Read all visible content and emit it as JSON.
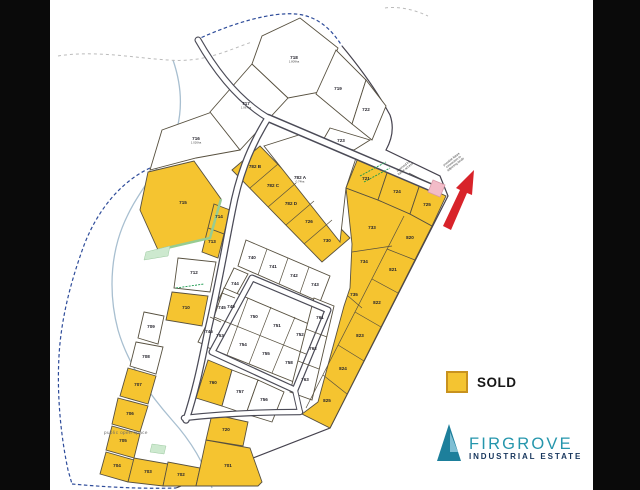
{
  "window": {
    "bar_color": "#0a0a0a",
    "bg": "#ffffff"
  },
  "legend": {
    "label": "SOLD",
    "swatch_color": "#F4C431",
    "swatch_border": "#C8921E"
  },
  "logo": {
    "title": "FIRGROVE",
    "subtitle": "INDUSTRIAL ESTATE",
    "teal": "#1D7F9B",
    "light_blue": "#7FBFD4",
    "navy": "#16355C"
  },
  "map": {
    "colors": {
      "sold": "#F5C430",
      "available": "#ffffff",
      "lot_line": "#57503f",
      "road_casing": "#4b4b57",
      "road_fill": "#ffffff",
      "label": "#26252e",
      "boundary_blue": "#2E4C9A",
      "stream": "#A8BFD0",
      "green": "#18984C",
      "arrow_red": "#D8232A",
      "pink": "#F3BCC8"
    },
    "paths": [
      {
        "d": "M150,168 C120,182 96,212 83,248 C70,284 61,320 59,356 C57,392 60,432 68,470 L72,484",
        "s": "#2E4C9A",
        "w": 1.2,
        "dash": "3.5,2.5"
      },
      {
        "d": "M72,484 C105,487 140,489 176,488",
        "s": "#2E4C9A",
        "w": 1.2,
        "dash": "3.5,2.5"
      },
      {
        "d": "M196,40 C235,22 272,12 296,14 C318,16 332,30 342,46",
        "s": "#2E4C9A",
        "w": 1.2,
        "dash": "3.5,2.5"
      },
      {
        "d": "M342,46 Q372,82 390,115 Q396,132 386,150 L440,176 L448,196 L330,428 L176,488",
        "s": "#45424e",
        "w": 1.2
      },
      {
        "d": "M173,60 C185,95 182,125 168,152 C150,180 128,205 118,240 C110,268 110,300 118,330 C128,365 150,395 172,420 C190,440 204,462 212,488",
        "s": "#A8BFD0",
        "w": 1.3
      },
      {
        "d": "M58,56 C95,50 135,58 168,60 C205,63 228,50 252,42",
        "s": "#bbbbbb",
        "w": 1,
        "dash": "3,3"
      },
      {
        "d": "M385,8 C400,6 415,10 428,16",
        "s": "#bbbbbb",
        "w": 1,
        "dash": "3,3"
      }
    ],
    "roads": [
      {
        "d": "M198,40 C215,70 238,100 268,118",
        "cw": 7,
        "fw": 4.8
      },
      {
        "d": "M268,118 L437,190",
        "cw": 8.5,
        "fw": 5.5
      },
      {
        "d": "M268,118 C248,150 238,180 232,212 C224,252 218,288 208,330 C202,360 196,390 186,420",
        "cw": 7.5,
        "fw": 5
      },
      {
        "d": "M252,278 L328,310 L295,390 L212,352 Z",
        "cw": 7,
        "fw": 4.6
      },
      {
        "d": "M295,390 L300,412",
        "cw": 6,
        "fw": 4
      },
      {
        "d": "M184,418 C220,414 262,412 300,412",
        "cw": 6.5,
        "fw": 4.2
      }
    ],
    "lots": [
      {
        "t": "716",
        "sold": false,
        "pts": "162,130 212,112 240,150 196,158 150,170",
        "x": 196,
        "y": 140,
        "a": "1.026ha"
      },
      {
        "t": "717",
        "sold": false,
        "pts": "210,112 252,64 288,98 240,150",
        "x": 246,
        "y": 105,
        "a": "1.067ha"
      },
      {
        "t": "718",
        "sold": false,
        "pts": "252,64 262,36 300,18 338,48 320,92 288,98",
        "x": 294,
        "y": 59,
        "a": "1.809ha"
      },
      {
        "t": "719",
        "sold": false,
        "pts": "316,94 336,50 366,80 352,124",
        "x": 338,
        "y": 90
      },
      {
        "t": "722",
        "sold": false,
        "pts": "352,124 366,80 386,106 372,140",
        "x": 366,
        "y": 111
      },
      {
        "t": "723",
        "sold": false,
        "pts": "330,128 370,140 354,150 322,142",
        "x": 341,
        "y": 142
      },
      {
        "t": "782 A",
        "sold": false,
        "pts": "264,146 302,134 356,158 346,188 340,242",
        "x": 300,
        "y": 179,
        "a": "0.74ha"
      },
      {
        "t": "715",
        "sold": true,
        "pts": "148,172 194,161 221,199 210,238 158,250 140,210",
        "x": 183,
        "y": 204
      },
      {
        "t": "714",
        "sold": true,
        "pts": "214,204 230,210 224,234 208,228",
        "x": 219,
        "y": 218
      },
      {
        "t": "713",
        "sold": true,
        "pts": "208,228 224,234 218,258 202,252",
        "x": 212,
        "y": 243
      },
      {
        "t": "712",
        "sold": false,
        "pts": "178,258 216,262 210,292 174,288",
        "x": 194,
        "y": 274
      },
      {
        "t": "710",
        "sold": true,
        "pts": "172,292 208,296 202,326 166,320",
        "x": 186,
        "y": 309
      },
      {
        "t": "709",
        "sold": false,
        "pts": "144,312 164,316 158,344 138,338",
        "x": 151,
        "y": 328
      },
      {
        "t": "708",
        "sold": false,
        "pts": "136,342 163,347 156,374 130,366",
        "x": 146,
        "y": 358
      },
      {
        "t": "707",
        "sold": true,
        "pts": "128,368 156,376 148,404 120,396",
        "x": 138,
        "y": 386
      },
      {
        "t": "706",
        "sold": true,
        "pts": "118,398 148,406 140,432 112,424",
        "x": 130,
        "y": 415
      },
      {
        "t": "705",
        "sold": true,
        "pts": "112,426 140,434 134,458 106,450",
        "x": 123,
        "y": 442
      },
      {
        "t": "704",
        "sold": true,
        "pts": "106,452 134,460 128,482 100,474",
        "x": 117,
        "y": 467
      },
      {
        "t": "703",
        "sold": true,
        "pts": "128,482 134,458 168,464 163,486",
        "x": 148,
        "y": 473
      },
      {
        "t": "702",
        "sold": true,
        "pts": "163,486 168,462 200,468 196,486",
        "x": 181,
        "y": 476
      },
      {
        "t": "701",
        "sold": true,
        "pts": "196,486 200,468 206,440 250,448 262,482 258,486",
        "x": 228,
        "y": 467
      },
      {
        "t": "720",
        "sold": true,
        "pts": "206,440 212,414 248,422 243,446",
        "x": 226,
        "y": 431
      },
      {
        "t": "760",
        "sold": true,
        "pts": "208,360 232,370 222,406 196,398",
        "x": 213,
        "y": 384
      },
      {
        "t": "757",
        "sold": false,
        "pts": "232,370 258,380 246,414 222,406",
        "x": 240,
        "y": 393
      },
      {
        "t": "756",
        "sold": false,
        "pts": "258,380 284,392 272,422 246,414",
        "x": 264,
        "y": 401
      },
      {
        "t": "721",
        "sold": true,
        "pts": "358,158 388,170 378,200 346,188",
        "x": 366,
        "y": 180
      },
      {
        "t": "724",
        "sold": true,
        "pts": "388,170 420,184 410,214 378,200",
        "x": 397,
        "y": 193
      },
      {
        "t": "725",
        "sold": true,
        "pts": "420,184 446,196 432,226 410,214",
        "x": 427,
        "y": 206
      }
    ],
    "bands": [
      {
        "sold": true,
        "pts": "232,170 260,146 350,238 322,262",
        "div": [
          [
            278,
            164,
            250,
            188
          ],
          [
            296,
            183,
            268,
            207
          ],
          [
            314,
            201,
            286,
            225
          ],
          [
            332,
            220,
            304,
            244
          ]
        ],
        "labels": [
          {
            "t": "782 B",
            "x": 255,
            "y": 168
          },
          {
            "t": "782 C",
            "x": 273,
            "y": 187
          },
          {
            "t": "782 D",
            "x": 291,
            "y": 205
          },
          {
            "t": "726",
            "x": 309,
            "y": 223
          },
          {
            "t": "730",
            "x": 327,
            "y": 242
          }
        ]
      },
      {
        "sold": false,
        "pts": "246,240 330,276 320,302 238,266",
        "div": [
          [
            267,
            249,
            258,
            275
          ],
          [
            288,
            258,
            279,
            284
          ],
          [
            309,
            267,
            300,
            293
          ]
        ],
        "labels": [
          {
            "t": "740",
            "x": 252,
            "y": 259
          },
          {
            "t": "741",
            "x": 273,
            "y": 268
          },
          {
            "t": "742",
            "x": 294,
            "y": 277
          },
          {
            "t": "743",
            "x": 315,
            "y": 286
          }
        ]
      },
      {
        "sold": false,
        "pts": "234,268 248,274 208,346 198,342",
        "div": [
          [
            235,
            298,
            222,
            293
          ],
          [
            221,
            322,
            210,
            317
          ]
        ],
        "labels": [
          {
            "t": "744",
            "x": 235,
            "y": 285
          },
          {
            "t": "745",
            "x": 222,
            "y": 309
          },
          {
            "t": "746",
            "x": 209,
            "y": 333
          }
        ]
      },
      {
        "sold": false,
        "pts": "224,288 316,327 294,382 204,346",
        "div": [
          [
            214,
            317,
            306,
            354
          ],
          [
            248,
            298,
            227,
            355
          ],
          [
            271,
            307,
            249,
            364
          ],
          [
            295,
            317,
            272,
            373
          ]
        ],
        "labels": [
          {
            "t": "749",
            "x": 231,
            "y": 308
          },
          {
            "t": "750",
            "x": 254,
            "y": 318
          },
          {
            "t": "751",
            "x": 277,
            "y": 327
          },
          {
            "t": "752",
            "x": 300,
            "y": 336
          },
          {
            "t": "753",
            "x": 220,
            "y": 337
          },
          {
            "t": "754",
            "x": 243,
            "y": 346
          },
          {
            "t": "755",
            "x": 266,
            "y": 355
          },
          {
            "t": "758",
            "x": 289,
            "y": 364
          }
        ]
      },
      {
        "sold": false,
        "pts": "314,298 334,306 312,400 290,392",
        "div": [
          [
            327,
            337,
            306,
            329
          ],
          [
            319,
            369,
            298,
            361
          ]
        ],
        "labels": [
          {
            "t": "761",
            "x": 320,
            "y": 319
          },
          {
            "t": "762",
            "x": 313,
            "y": 350
          },
          {
            "t": "763",
            "x": 305,
            "y": 381
          }
        ]
      },
      {
        "sold": true,
        "pts": "346,188 378,200 410,214 432,226 330,428 302,414 318,402 344,306 350,288 352,244",
        "div": [
          [
            404,
            216,
            306,
            408
          ],
          [
            415,
            260,
            387,
            249
          ],
          [
            398,
            293,
            372,
            279
          ],
          [
            381,
            327,
            355,
            312
          ],
          [
            364,
            361,
            338,
            345
          ],
          [
            347,
            394,
            323,
            375
          ],
          [
            352,
            252,
            392,
            246
          ],
          [
            348,
            296,
            362,
            308
          ]
        ],
        "labels": [
          {
            "t": "733",
            "x": 372,
            "y": 229
          },
          {
            "t": "734",
            "x": 364,
            "y": 263
          },
          {
            "t": "735",
            "x": 354,
            "y": 296
          },
          {
            "t": "820",
            "x": 410,
            "y": 239
          },
          {
            "t": "821",
            "x": 393,
            "y": 271
          },
          {
            "t": "822",
            "x": 377,
            "y": 304
          },
          {
            "t": "823",
            "x": 360,
            "y": 337
          },
          {
            "t": "824",
            "x": 343,
            "y": 370
          },
          {
            "t": "825",
            "x": 327,
            "y": 402
          }
        ]
      }
    ],
    "extras": {
      "greens": [
        {
          "type": "pl",
          "pts": "221,199 210,238 158,250",
          "s": "#97CC92",
          "w": 2.5
        },
        {
          "type": "pg",
          "pts": "146,252 170,246 168,256 144,260",
          "f": "#CDE9CF",
          "s": "#9CC9A0",
          "w": 0.5
        },
        {
          "type": "pg",
          "pts": "152,444 166,446 164,454 150,452",
          "f": "#CDE9CF",
          "s": "#9CC9A0",
          "w": 0.5
        },
        {
          "type": "ln",
          "x1": 176,
          "y1": 288,
          "x2": 204,
          "y2": 284,
          "s": "#18984C",
          "w": 0.9,
          "dash": "2,1.2"
        },
        {
          "type": "ln",
          "x1": 360,
          "y1": 176,
          "x2": 386,
          "y2": 162,
          "s": "#18984C",
          "w": 0.9,
          "dash": "2,1.2"
        },
        {
          "type": "ln",
          "x1": 364,
          "y1": 182,
          "x2": 390,
          "y2": 168,
          "s": "#18984C",
          "w": 0.9,
          "dash": "2,1.2"
        }
      ],
      "pink_square": {
        "pts": "433,180 445,185 440,197 428,192",
        "f": "#F3BCC8",
        "s": "#D89AA8"
      },
      "arrow": {
        "pts": "443,226 451,230 467,193 472,195 474,170 456,188 460,190",
        "f": "#D8232A"
      },
      "leader": {
        "x1": 409,
        "y1": 173,
        "x2": 429,
        "y2": 183
      },
      "notes": [
        {
          "x": 404,
          "y": 167,
          "rot": -38,
          "lines": [
            "reserved for",
            "future access"
          ]
        },
        {
          "x": 452,
          "y": 160,
          "rot": -38,
          "lines": [
            "possible future",
            "connection to",
            "adjoining lands"
          ]
        }
      ],
      "open_space": {
        "text": "public open space",
        "x": 104,
        "y": 434
      }
    }
  }
}
